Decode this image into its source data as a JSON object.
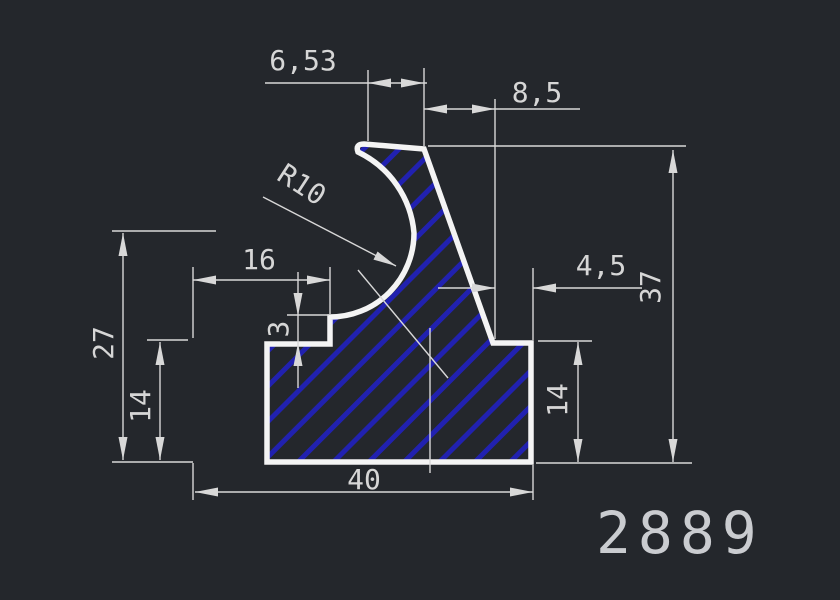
{
  "canvas": {
    "width": 840,
    "height": 600,
    "background": "#24272c"
  },
  "part_number": "2889",
  "styles": {
    "outline_color": "#f4f4f4",
    "outline_width": 5.5,
    "thin_color": "#d8d8d8",
    "thin_width": 1.4,
    "hatch_color": "#2121b0",
    "hatch_spacing": 25,
    "hatch_line_width": 5,
    "text_color": "#d6d6d6",
    "font_size": 28,
    "arrow_length": 23,
    "arrow_half_width": 4.5,
    "part_number_color": "#caccd0"
  },
  "profile": {
    "name": "extrusion-profile-section",
    "path": "M 267,462 L 267,344 L 330,344 L 330,317 A 84 84 0 0 0 414,233 A 99 99 0 0 0 358,152 Q 355,144 364,144 L 424,149 L 493,343 L 531,343 L 531,462 Z"
  },
  "thin_lines": [
    {
      "name": "ext-line-6-53-left",
      "x1": 368,
      "y1": 70,
      "x2": 368,
      "y2": 141
    },
    {
      "name": "ext-line-6-53-8-5-shared",
      "x1": 424,
      "y1": 68,
      "x2": 424,
      "y2": 146
    },
    {
      "name": "ext-line-8-5-4-5-shared",
      "x1": 495,
      "y1": 99,
      "x2": 495,
      "y2": 339
    },
    {
      "name": "dim-line-6-53",
      "x1": 265,
      "y1": 83,
      "x2": 427,
      "y2": 83
    },
    {
      "name": "dim-line-8-5",
      "x1": 424,
      "y1": 109,
      "x2": 580,
      "y2": 109
    },
    {
      "name": "ext-line-37-top",
      "x1": 428,
      "y1": 146,
      "x2": 686,
      "y2": 146
    },
    {
      "name": "dim-line-37",
      "x1": 673,
      "y1": 150,
      "x2": 673,
      "y2": 462
    },
    {
      "name": "ext-line-37-14-bottom",
      "x1": 536,
      "y1": 463,
      "x2": 692,
      "y2": 463
    },
    {
      "name": "dim-line-4-5-left",
      "x1": 438,
      "y1": 288,
      "x2": 495,
      "y2": 288
    },
    {
      "name": "dim-line-4-5-right",
      "x1": 533,
      "y1": 288,
      "x2": 642,
      "y2": 288
    },
    {
      "name": "ext-line-4-5-right",
      "x1": 533,
      "y1": 268,
      "x2": 533,
      "y2": 340
    },
    {
      "name": "ext-line-14-right-top",
      "x1": 538,
      "y1": 341,
      "x2": 592,
      "y2": 341
    },
    {
      "name": "dim-line-14-right",
      "x1": 578,
      "y1": 342,
      "x2": 578,
      "y2": 462
    },
    {
      "name": "dim-line-40",
      "x1": 195,
      "y1": 492,
      "x2": 533,
      "y2": 492
    },
    {
      "name": "ext-line-40-left",
      "x1": 193,
      "y1": 463,
      "x2": 193,
      "y2": 500
    },
    {
      "name": "ext-line-40-right",
      "x1": 533,
      "y1": 465,
      "x2": 533,
      "y2": 500
    },
    {
      "name": "ext-line-27-14-bottom",
      "x1": 112,
      "y1": 462,
      "x2": 193,
      "y2": 462
    },
    {
      "name": "ext-line-27-top",
      "x1": 112,
      "y1": 231,
      "x2": 216,
      "y2": 231
    },
    {
      "name": "dim-line-27",
      "x1": 123,
      "y1": 233,
      "x2": 123,
      "y2": 460
    },
    {
      "name": "dim-line-14-left",
      "x1": 160,
      "y1": 342,
      "x2": 160,
      "y2": 460
    },
    {
      "name": "ext-line-14-left-top",
      "x1": 147,
      "y1": 340,
      "x2": 188,
      "y2": 340
    },
    {
      "name": "ext-line-16-left",
      "x1": 193,
      "y1": 267,
      "x2": 193,
      "y2": 338
    },
    {
      "name": "ext-line-16-right",
      "x1": 330,
      "y1": 267,
      "x2": 330,
      "y2": 314
    },
    {
      "name": "dim-line-16",
      "x1": 193,
      "y1": 280,
      "x2": 330,
      "y2": 280
    },
    {
      "name": "ext-line-3-top",
      "x1": 287,
      "y1": 315,
      "x2": 329,
      "y2": 315
    },
    {
      "name": "dim-line-3",
      "x1": 298,
      "y1": 272,
      "x2": 298,
      "y2": 388
    },
    {
      "name": "leader-line-r10",
      "x1": 263,
      "y1": 197,
      "x2": 396,
      "y2": 266
    },
    {
      "name": "aux-diagonal-line",
      "x1": 358,
      "y1": 270,
      "x2": 448,
      "y2": 378
    },
    {
      "name": "aux-vertical-line",
      "x1": 430,
      "y1": 328,
      "x2": 430,
      "y2": 473
    }
  ],
  "arrows": [
    {
      "name": "arrow-6-53-left",
      "x": 368,
      "y": 83,
      "angle": 180
    },
    {
      "name": "arrow-6-53-right",
      "x": 424,
      "y": 83,
      "angle": 0
    },
    {
      "name": "arrow-8-5-left",
      "x": 424,
      "y": 109,
      "angle": 180
    },
    {
      "name": "arrow-8-5-right",
      "x": 495,
      "y": 109,
      "angle": 0
    },
    {
      "name": "arrow-37-top",
      "x": 673,
      "y": 150,
      "angle": -90
    },
    {
      "name": "arrow-37-bottom",
      "x": 673,
      "y": 462,
      "angle": 90
    },
    {
      "name": "arrow-4-5-left",
      "x": 495,
      "y": 288,
      "angle": 0
    },
    {
      "name": "arrow-4-5-right",
      "x": 533,
      "y": 288,
      "angle": 180
    },
    {
      "name": "arrow-14-right-top",
      "x": 578,
      "y": 342,
      "angle": -90
    },
    {
      "name": "arrow-14-right-bot",
      "x": 578,
      "y": 462,
      "angle": 90
    },
    {
      "name": "arrow-40-left",
      "x": 195,
      "y": 492,
      "angle": 180
    },
    {
      "name": "arrow-40-right",
      "x": 533,
      "y": 492,
      "angle": 0
    },
    {
      "name": "arrow-27-top",
      "x": 123,
      "y": 233,
      "angle": -90
    },
    {
      "name": "arrow-27-bottom",
      "x": 123,
      "y": 460,
      "angle": 90
    },
    {
      "name": "arrow-14-left-top",
      "x": 160,
      "y": 342,
      "angle": -90
    },
    {
      "name": "arrow-14-left-bot",
      "x": 160,
      "y": 460,
      "angle": 90
    },
    {
      "name": "arrow-16-left",
      "x": 193,
      "y": 280,
      "angle": 180
    },
    {
      "name": "arrow-16-right",
      "x": 330,
      "y": 280,
      "angle": 0
    },
    {
      "name": "arrow-3-top",
      "x": 298,
      "y": 316,
      "angle": 90
    },
    {
      "name": "arrow-3-bottom",
      "x": 298,
      "y": 343,
      "angle": -90
    },
    {
      "name": "arrow-r10-leader",
      "x": 396,
      "y": 266,
      "angle": 27
    }
  ],
  "labels": [
    {
      "name": "dim-text-6-53",
      "text": "6,53",
      "x": 303,
      "y": 62,
      "rotate": 0
    },
    {
      "name": "dim-text-8-5",
      "text": "8,5",
      "x": 537,
      "y": 94,
      "rotate": 0
    },
    {
      "name": "dim-text-37",
      "text": "37",
      "x": 652,
      "y": 287,
      "rotate": -90
    },
    {
      "name": "dim-text-4-5",
      "text": "4,5",
      "x": 601,
      "y": 267,
      "rotate": 0
    },
    {
      "name": "dim-text-27",
      "text": "27",
      "x": 105,
      "y": 343,
      "rotate": -90
    },
    {
      "name": "dim-text-14-left",
      "text": "14",
      "x": 142,
      "y": 406,
      "rotate": -90
    },
    {
      "name": "dim-text-16",
      "text": "16",
      "x": 259,
      "y": 261,
      "rotate": 0
    },
    {
      "name": "dim-text-3",
      "text": "3",
      "x": 280,
      "y": 329,
      "rotate": -90
    },
    {
      "name": "dim-text-14-right",
      "text": "14",
      "x": 559,
      "y": 400,
      "rotate": -90
    },
    {
      "name": "dim-text-40",
      "text": "40",
      "x": 364,
      "y": 481,
      "rotate": 0
    },
    {
      "name": "radius-text-r10",
      "text": "R10",
      "x": 301,
      "y": 186,
      "rotate": 33
    }
  ]
}
